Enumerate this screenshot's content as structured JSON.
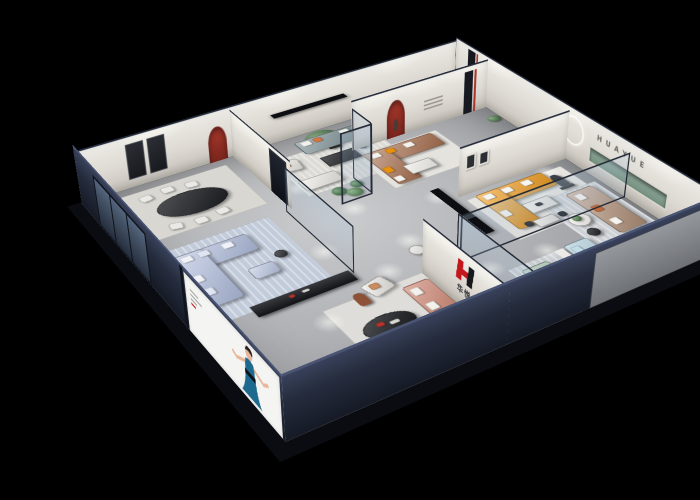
{
  "brand": {
    "logo_text": "华悦",
    "wall_letters": "HUAYUE"
  },
  "palette": {
    "background": "#000000",
    "accent_red": "#a8382c",
    "logo_red": "#c4161d",
    "wall_white": "#ddd9d2",
    "wall_dark_navy": "#252c3d",
    "floor_gray": "#b2b3b6",
    "glass_frame": "#242a36",
    "niche_green": "#7e998c",
    "sofa_orange": "#f09b1d",
    "sofa_brown": "#aa7150",
    "sofa_coral": "#c87a65",
    "sofa_periwinkle": "#b3c0e0",
    "sofa_teal": "#74888e",
    "sofa_tan": "#b19078",
    "sofa_green": "#9bb7a2",
    "sofa_lightblue": "#a8cad8",
    "poster_dress_teal": "#1d6a8e"
  },
  "furniture": [
    {
      "n": "rug-dining",
      "t": "rug",
      "x": 22,
      "y": 12,
      "w": 138,
      "h": 94,
      "c": "#d8d7d2"
    },
    {
      "n": "rug-teal-lounge",
      "t": "rug rug-striped",
      "x": 202,
      "y": 34,
      "w": 132,
      "h": 84,
      "c": "#dcdbd6"
    },
    {
      "n": "rug-blue-room",
      "t": "rug rug-striped",
      "x": 28,
      "y": 128,
      "w": 120,
      "h": 132,
      "c": "#c2cbda"
    },
    {
      "n": "rug-brown-zone",
      "t": "rug",
      "x": 286,
      "y": 74,
      "w": 108,
      "h": 80,
      "c": "#e5e3de"
    },
    {
      "n": "rug-orange-zone",
      "t": "rug",
      "x": 334,
      "y": 214,
      "w": 126,
      "h": 88,
      "c": "#e7e5e0"
    },
    {
      "n": "rug-tan-zone",
      "t": "rug rug-striped",
      "x": 390,
      "y": 258,
      "w": 80,
      "h": 94,
      "c": "#ced2d6"
    },
    {
      "n": "rug-center-front",
      "t": "rug",
      "x": 112,
      "y": 294,
      "w": 118,
      "h": 124,
      "c": "#deddd9"
    },
    {
      "n": "rug-green-cluster",
      "t": "rug rug-striped",
      "x": 292,
      "y": 336,
      "w": 70,
      "h": 86,
      "c": "#c8ccd1"
    },
    {
      "n": "rug-bed",
      "t": "rug rug-striped",
      "x": 300,
      "y": 370,
      "w": 92,
      "h": 24,
      "c": "#d3d6d9"
    },
    {
      "n": "floor-spotlight",
      "t": "spot",
      "x": 185,
      "y": 82,
      "w": 30,
      "h": 30
    },
    {
      "n": "floor-spotlight",
      "t": "spot",
      "x": 148,
      "y": 198,
      "w": 30,
      "h": 30
    },
    {
      "n": "floor-spotlight",
      "t": "spot",
      "x": 214,
      "y": 148,
      "w": 30,
      "h": 30
    },
    {
      "n": "floor-spotlight",
      "t": "spot",
      "x": 228,
      "y": 228,
      "w": 30,
      "h": 30
    },
    {
      "n": "floor-spotlight",
      "t": "spot",
      "x": 182,
      "y": 260,
      "w": 30,
      "h": 30
    },
    {
      "n": "floor-spotlight",
      "t": "spot",
      "x": 298,
      "y": 178,
      "w": 30,
      "h": 30
    },
    {
      "n": "floor-spotlight",
      "t": "spot",
      "x": 352,
      "y": 162,
      "w": 30,
      "h": 30
    },
    {
      "n": "floor-spotlight",
      "t": "spot",
      "x": 266,
      "y": 310,
      "w": 30,
      "h": 30
    },
    {
      "n": "floor-spotlight",
      "t": "spot",
      "x": 330,
      "y": 316,
      "w": 30,
      "h": 30
    },
    {
      "n": "floor-spotlight",
      "t": "spot",
      "x": 424,
      "y": 202,
      "w": 30,
      "h": 30
    },
    {
      "n": "floor-spotlight",
      "t": "spot",
      "x": 450,
      "y": 356,
      "w": 30,
      "h": 30
    },
    {
      "n": "floor-spotlight",
      "t": "spot",
      "x": 94,
      "y": 296,
      "w": 30,
      "h": 30
    },
    {
      "n": "floor-spotlight",
      "t": "spot",
      "x": 204,
      "y": 370,
      "w": 30,
      "h": 30
    },
    {
      "n": "floor-spotlight",
      "t": "spot",
      "x": 416,
      "y": 122,
      "w": 30,
      "h": 30
    },
    {
      "n": "floor-spotlight",
      "t": "spot",
      "x": 258,
      "y": 58,
      "w": 30,
      "h": 30
    },
    {
      "n": "floor-spotlight",
      "t": "spot",
      "x": 390,
      "y": 228,
      "w": 30,
      "h": 30
    },
    {
      "n": "dining-table-black-oval",
      "t": "table round",
      "x": 58,
      "y": 38,
      "w": 78,
      "h": 44,
      "c": "#17191d"
    },
    {
      "n": "dining-chair",
      "t": "chair",
      "x": 52,
      "y": 22,
      "w": 14,
      "h": 12,
      "c": "#eae9e5",
      "r": -10
    },
    {
      "n": "dining-chair",
      "t": "chair",
      "x": 78,
      "y": 18,
      "w": 14,
      "h": 12,
      "c": "#eae9e5"
    },
    {
      "n": "dining-chair",
      "t": "chair",
      "x": 104,
      "y": 22,
      "w": 14,
      "h": 12,
      "c": "#eae9e5",
      "r": 8
    },
    {
      "n": "dining-chair",
      "t": "chair",
      "x": 56,
      "y": 86,
      "w": 14,
      "h": 12,
      "c": "#eae9e5",
      "r": 12
    },
    {
      "n": "dining-chair",
      "t": "chair",
      "x": 82,
      "y": 90,
      "w": 14,
      "h": 12,
      "c": "#eae9e5"
    },
    {
      "n": "dining-chair",
      "t": "chair",
      "x": 108,
      "y": 86,
      "w": 14,
      "h": 12,
      "c": "#eae9e5",
      "r": -8
    },
    {
      "n": "potted-tree",
      "t": "plant",
      "x": 256,
      "y": 2,
      "w": 44,
      "h": 38,
      "c": "#4a7a45"
    },
    {
      "n": "tree-pot",
      "t": "console",
      "x": 272,
      "y": 36,
      "w": 14,
      "h": 10,
      "c": "#2c2e33"
    },
    {
      "n": "sofa-teal-gray",
      "t": "sofa",
      "x": 244,
      "y": 12,
      "w": 88,
      "h": 30,
      "c": "#74888e"
    },
    {
      "n": "pillow",
      "t": "cushion",
      "x": 250,
      "y": 15,
      "w": 12,
      "h": 10,
      "c": "#f2f1ed"
    },
    {
      "n": "pillow",
      "t": "cushion",
      "x": 266,
      "y": 15,
      "w": 10,
      "h": 9,
      "c": "#d5763e"
    },
    {
      "n": "pillow",
      "t": "cushion",
      "x": 300,
      "y": 15,
      "w": 12,
      "h": 10,
      "c": "#f2f1ed"
    },
    {
      "n": "armchair-white",
      "t": "seat",
      "x": 202,
      "y": 40,
      "w": 27,
      "h": 24,
      "c": "#eceae5",
      "r": 8
    },
    {
      "n": "pillow",
      "t": "cushion",
      "x": 208,
      "y": 45,
      "w": 10,
      "h": 9,
      "c": "#d5763e"
    },
    {
      "n": "loveseat-white",
      "t": "sofa",
      "x": 206,
      "y": 86,
      "w": 46,
      "h": 22,
      "c": "#edece7"
    },
    {
      "n": "coffee-table-black",
      "t": "table",
      "x": 252,
      "y": 56,
      "w": 42,
      "h": 22,
      "c": "#1b1d21"
    },
    {
      "n": "side-table",
      "t": "table round",
      "x": 298,
      "y": 50,
      "w": 14,
      "h": 14,
      "c": "#2a2c31"
    },
    {
      "n": "sofa-periwinkle",
      "t": "sofa",
      "x": 34,
      "y": 142,
      "w": 80,
      "h": 32,
      "c": "#b3c0e0"
    },
    {
      "n": "sofa-periwinkle",
      "t": "sofa",
      "x": 34,
      "y": 142,
      "w": 32,
      "h": 92,
      "c": "#b3c0e0"
    },
    {
      "n": "pillow",
      "t": "cushion",
      "x": 40,
      "y": 146,
      "w": 12,
      "h": 10,
      "c": "#f0f2f8"
    },
    {
      "n": "pillow",
      "t": "cushion",
      "x": 58,
      "y": 146,
      "w": 12,
      "h": 10,
      "c": "#dfe5f2"
    },
    {
      "n": "pillow",
      "t": "cushion",
      "x": 84,
      "y": 146,
      "w": 12,
      "h": 10,
      "c": "#f0f2f8"
    },
    {
      "n": "pillow",
      "t": "cushion",
      "x": 36,
      "y": 180,
      "w": 10,
      "h": 12,
      "c": "#f0f2f8"
    },
    {
      "n": "pillow",
      "t": "cushion",
      "x": 36,
      "y": 204,
      "w": 10,
      "h": 12,
      "c": "#dfe5f2"
    },
    {
      "n": "ottoman-periwinkle",
      "t": "seat",
      "x": 86,
      "y": 198,
      "w": 28,
      "h": 20,
      "c": "#bcc8e4"
    },
    {
      "n": "media-console-dark",
      "t": "console",
      "x": 60,
      "y": 252,
      "w": 106,
      "h": 18,
      "c": "#141519"
    },
    {
      "n": "console-decor-red",
      "t": "cushion",
      "x": 98,
      "y": 256,
      "w": 6,
      "h": 5,
      "c": "#b3342c"
    },
    {
      "n": "console-decor",
      "t": "cushion",
      "x": 112,
      "y": 256,
      "w": 8,
      "h": 4,
      "c": "#d8d8d4"
    },
    {
      "n": "side-table",
      "t": "table round",
      "x": 120,
      "y": 186,
      "w": 13,
      "h": 13,
      "c": "#2a2c31"
    },
    {
      "n": "sofa-brown-leather",
      "t": "sofa",
      "x": 294,
      "y": 76,
      "w": 92,
      "h": 30,
      "c": "#aa7150"
    },
    {
      "n": "sofa-brown-leather",
      "t": "sofa",
      "x": 294,
      "y": 76,
      "w": 30,
      "h": 74,
      "c": "#aa7150"
    },
    {
      "n": "pillow",
      "t": "cushion",
      "x": 300,
      "y": 80,
      "w": 12,
      "h": 10,
      "c": "#f4f2ed"
    },
    {
      "n": "pillow",
      "t": "cushion",
      "x": 320,
      "y": 80,
      "w": 11,
      "h": 10,
      "c": "#e8920f"
    },
    {
      "n": "pillow",
      "t": "cushion",
      "x": 344,
      "y": 80,
      "w": 12,
      "h": 10,
      "c": "#f4f2ed"
    },
    {
      "n": "pillow",
      "t": "cushion",
      "x": 296,
      "y": 112,
      "w": 10,
      "h": 12,
      "c": "#e8920f"
    },
    {
      "n": "pillow",
      "t": "cushion",
      "x": 296,
      "y": 134,
      "w": 10,
      "h": 11,
      "c": "#f4f2ed"
    },
    {
      "n": "coffee-table-white",
      "t": "table",
      "x": 318,
      "y": 120,
      "w": 34,
      "h": 20,
      "c": "#efeeea"
    },
    {
      "n": "plant-small",
      "t": "plant",
      "x": 458,
      "y": 82,
      "w": 16,
      "h": 14,
      "c": "#4d7d48"
    },
    {
      "n": "sofa-orange",
      "t": "sofa",
      "x": 346,
      "y": 212,
      "w": 88,
      "h": 30,
      "c": "#f09b1d"
    },
    {
      "n": "sofa-orange",
      "t": "sofa",
      "x": 346,
      "y": 212,
      "w": 30,
      "h": 76,
      "c": "#f09b1d"
    },
    {
      "n": "pillow",
      "t": "cushion",
      "x": 352,
      "y": 216,
      "w": 12,
      "h": 10,
      "c": "#f6f5f1"
    },
    {
      "n": "pillow",
      "t": "cushion",
      "x": 376,
      "y": 216,
      "w": 12,
      "h": 10,
      "c": "#f6f5f1"
    },
    {
      "n": "pillow",
      "t": "cushion",
      "x": 402,
      "y": 216,
      "w": 12,
      "h": 10,
      "c": "#f6f5f1"
    },
    {
      "n": "pillow",
      "t": "cushion",
      "x": 348,
      "y": 250,
      "w": 10,
      "h": 12,
      "c": "#f6f5f1"
    },
    {
      "n": "coffee-table-white",
      "t": "table",
      "x": 376,
      "y": 252,
      "w": 34,
      "h": 20,
      "c": "#f1f0ec"
    },
    {
      "n": "table-decor",
      "t": "cushion",
      "x": 388,
      "y": 258,
      "w": 8,
      "h": 6,
      "c": "#2a2d32"
    },
    {
      "n": "display-table-white",
      "t": "table",
      "x": 366,
      "y": 282,
      "w": 26,
      "h": 14,
      "c": "#eceae6"
    },
    {
      "n": "chair-dark",
      "t": "chair",
      "x": 356,
      "y": 280,
      "w": 9,
      "h": 9,
      "c": "#2b2e34"
    },
    {
      "n": "chair-dark",
      "t": "chair",
      "x": 396,
      "y": 284,
      "w": 9,
      "h": 9,
      "c": "#2b2e34"
    },
    {
      "n": "runner-statue",
      "t": "statue",
      "x": 434,
      "y": 224,
      "w": 12,
      "h": 26,
      "c": "#3a3f45"
    },
    {
      "n": "statue-base",
      "t": "console",
      "x": 430,
      "y": 248,
      "w": 18,
      "h": 5,
      "c": "#202328"
    },
    {
      "n": "sofa-tan",
      "t": "sofa",
      "x": 426,
      "y": 262,
      "w": 36,
      "h": 86,
      "c": "#b19078"
    },
    {
      "n": "pillow",
      "t": "cushion",
      "x": 432,
      "y": 268,
      "w": 10,
      "h": 12,
      "c": "#f4f3ee"
    },
    {
      "n": "pillow",
      "t": "cushion",
      "x": 432,
      "y": 294,
      "w": 10,
      "h": 12,
      "c": "#c06a38"
    },
    {
      "n": "pillow",
      "t": "cushion",
      "x": 432,
      "y": 322,
      "w": 10,
      "h": 12,
      "c": "#f4f3ee"
    },
    {
      "n": "coffee-table-round",
      "t": "table round",
      "x": 396,
      "y": 294,
      "w": 24,
      "h": 24,
      "c": "#f2f1ec"
    },
    {
      "n": "plant-small",
      "t": "plant",
      "x": 402,
      "y": 298,
      "w": 10,
      "h": 10,
      "c": "#4d7d48"
    },
    {
      "n": "tray-table-black",
      "t": "table round",
      "x": 398,
      "y": 324,
      "w": 14,
      "h": 14,
      "c": "#1c1e22"
    },
    {
      "n": "console-white",
      "t": "console",
      "x": 350,
      "y": 336,
      "w": 10,
      "h": 72,
      "c": "#eae9e4"
    },
    {
      "n": "sofa-lightblue",
      "t": "sofa",
      "x": 362,
      "y": 334,
      "w": 30,
      "h": 74,
      "c": "#a8cad8"
    },
    {
      "n": "pillow",
      "t": "cushion",
      "x": 366,
      "y": 340,
      "w": 10,
      "h": 12,
      "c": "#c2dde8"
    },
    {
      "n": "pillow",
      "t": "cushion",
      "x": 366,
      "y": 366,
      "w": 10,
      "h": 12,
      "c": "#c2dde8"
    },
    {
      "n": "pillow",
      "t": "cushion",
      "x": 366,
      "y": 390,
      "w": 10,
      "h": 12,
      "c": "#c2dde8"
    },
    {
      "n": "sofa-sage-green",
      "t": "sofa",
      "x": 302,
      "y": 344,
      "w": 32,
      "h": 76,
      "c": "#9bb7a2"
    },
    {
      "n": "pillow",
      "t": "cushion",
      "x": 306,
      "y": 350,
      "w": 10,
      "h": 12,
      "c": "#f2f1ec"
    },
    {
      "n": "pillow",
      "t": "cushion",
      "x": 306,
      "y": 376,
      "w": 10,
      "h": 12,
      "c": "#f2f1ec"
    },
    {
      "n": "coffee-table-round",
      "t": "table round",
      "x": 326,
      "y": 400,
      "w": 20,
      "h": 16,
      "c": "#f0efeb"
    },
    {
      "n": "plant-small",
      "t": "plant",
      "x": 338,
      "y": 388,
      "w": 16,
      "h": 14,
      "c": "#4d7d48"
    },
    {
      "n": "bed-gray",
      "t": "bed",
      "x": 308,
      "y": 392,
      "w": 80,
      "h": 30,
      "c": "#d8d8d5"
    },
    {
      "n": "bed-pillow",
      "t": "cushion",
      "x": 314,
      "y": 396,
      "w": 14,
      "h": 9,
      "c": "#f6f6f3"
    },
    {
      "n": "bed-pillow",
      "t": "cushion",
      "x": 334,
      "y": 396,
      "w": 14,
      "h": 9,
      "c": "#f6f6f3"
    },
    {
      "n": "bed-throw",
      "t": "cushion",
      "x": 358,
      "y": 392,
      "w": 12,
      "h": 30,
      "c": "#b9bbbe"
    },
    {
      "n": "sofa-coral",
      "t": "sofa",
      "x": 192,
      "y": 304,
      "w": 30,
      "h": 78,
      "c": "#c87a65"
    },
    {
      "n": "pillow",
      "t": "cushion",
      "x": 196,
      "y": 310,
      "w": 10,
      "h": 12,
      "c": "#f3f1ec"
    },
    {
      "n": "pillow",
      "t": "cushion",
      "x": 196,
      "y": 336,
      "w": 10,
      "h": 12,
      "c": "#f3f1ec"
    },
    {
      "n": "pillow",
      "t": "cushion",
      "x": 196,
      "y": 360,
      "w": 10,
      "h": 12,
      "c": "#e9e2d9"
    },
    {
      "n": "armchair-white",
      "t": "seat",
      "x": 162,
      "y": 278,
      "w": 27,
      "h": 23,
      "c": "#edebe6",
      "r": -14
    },
    {
      "n": "pillow",
      "t": "cushion",
      "x": 168,
      "y": 283,
      "w": 10,
      "h": 9,
      "c": "#c98d5f"
    },
    {
      "n": "coffee-table-black-oval",
      "t": "table round",
      "x": 126,
      "y": 328,
      "w": 54,
      "h": 32,
      "c": "#15171b"
    },
    {
      "n": "table-decor-red",
      "t": "cushion",
      "x": 142,
      "y": 336,
      "w": 8,
      "h": 6,
      "c": "#b3342c"
    },
    {
      "n": "table-decor",
      "t": "cushion",
      "x": 154,
      "y": 340,
      "w": 10,
      "h": 5,
      "c": "#d9d8d4"
    },
    {
      "n": "daybed-white",
      "t": "seat",
      "x": 148,
      "y": 392,
      "w": 46,
      "h": 22,
      "c": "#efeee9"
    },
    {
      "n": "terracotta-statue",
      "t": "statue",
      "x": 146,
      "y": 288,
      "w": 12,
      "h": 20,
      "c": "#8d5138"
    },
    {
      "n": "media-bench-front",
      "t": "console",
      "x": 98,
      "y": 402,
      "w": 84,
      "h": 16,
      "c": "#141519"
    },
    {
      "n": "vitrine-plant",
      "t": "plant",
      "x": 226,
      "y": 118,
      "w": 16,
      "h": 16,
      "c": "#3f7a45"
    },
    {
      "n": "vitrine-plant",
      "t": "plant",
      "x": 238,
      "y": 128,
      "w": 18,
      "h": 16,
      "c": "#57934f"
    },
    {
      "n": "vitrine-plant",
      "t": "plant",
      "x": 250,
      "y": 116,
      "w": 14,
      "h": 14,
      "c": "#3f7a45"
    },
    {
      "n": "side-table-white",
      "t": "table round",
      "x": 232,
      "y": 252,
      "w": 16,
      "h": 16,
      "c": "#eceae6"
    },
    {
      "n": "pendant-light-bar",
      "t": "pendant",
      "x": 264,
      "y": 246,
      "w": 10,
      "h": 90
    },
    {
      "n": "pendant-light-bar",
      "t": "pendant",
      "x": 210,
      "y": 26,
      "w": 92,
      "h": 9
    }
  ]
}
